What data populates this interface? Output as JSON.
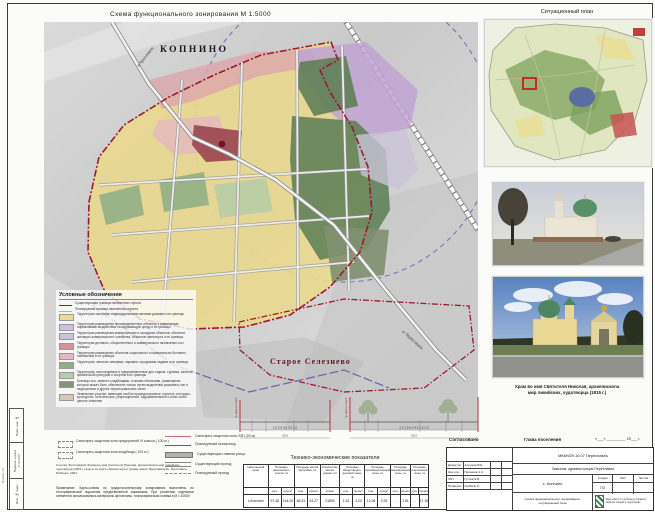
{
  "page": {
    "map_title": "Схема функционального зонирования М 1:5000",
    "compass": "С"
  },
  "map": {
    "town": "КОПНИНО",
    "village": "Старое Селезнево",
    "road_top": "в Ярославль",
    "road_bottom": "в Переславль"
  },
  "legend": {
    "title": "Условные обозначения",
    "lines": [
      {
        "label": "Существующая граница населенного пункта"
      },
      {
        "label": "Планируемая граница населенного пункта"
      }
    ],
    "zones": [
      {
        "color": "#ecd995",
        "label": "Территории застройки индивидуальными жилыми домами и их границы"
      },
      {
        "color": "#d2bfe0",
        "label": "Территории размещения производственных объектов с различными нормативами воздействия на окружающую среду и их границы"
      },
      {
        "color": "#c9c4d8",
        "label": "Территории размещения коммунальных и складских объектов, объектов жилищно-коммунального хозяйства, объектов транспорта и их границы"
      },
      {
        "color": "#d4929c",
        "label": "Территории делового, общественного и коммерческого назначения и их границы"
      },
      {
        "color": "#e6b8c0",
        "label": "Территории размещения объектов социального и коммунально-бытового назначения и их границы"
      },
      {
        "color": "#8fae85",
        "label": "Территории, занятые скверами, парками, городскими садами и их границы"
      },
      {
        "color": "#b5cda8",
        "label": "Территории, используемые и предназначенные для отдыха, туризма, занятий физической культурой и спортом и их границы"
      },
      {
        "color": "#879277",
        "label": "Границы зон, занятых кладбищами, и иными объектами, размещение которых может быть обеспечено только путем выделения указанных зон и недопустимо в других территориальных зонах"
      },
      {
        "color": "#d6c7b8",
        "label": "Земельные участки, имеющие особое природоохранное, научное, историко-культурное, эстетическое, рекреационное, оздоровительное и иное особо ценное значение"
      }
    ],
    "sanitary": [
      {
        "label": "Санитарно-защитная зона предприятий IV класса ( 100 м )"
      },
      {
        "label": "Санитарно-защитная зона кладбища ( 100 м )"
      }
    ],
    "right_items": [
      {
        "label": "Санитарно-защитная зона ЛЭП (20 м)"
      },
      {
        "label": "Планируемый газопровод"
      },
      {
        "label": "Существующая главная улица"
      },
      {
        "label": "Существующий проезд"
      },
      {
        "label": "Планируемый проезд"
      }
    ]
  },
  "profiles": {
    "redline": "Гр. красных линий",
    "p1_dims": "1,5      3,5      6,0      3,5      1,5",
    "p1_total": "15,0",
    "p2_dims": "2,0    1,5    6,0    4,5    1,5    2,0",
    "p2_total": "25,0"
  },
  "notes": {
    "reference": "Ссылка: Фотографии Храма во имя Святителя Николая, архиепископа мир ликийских, чудотворца (1815 г.) взяты из книги «Монастыри и храмы земли Ярославской», Ярославль-Рыбинск, 2001.",
    "note": "Примечание. Карты-схемы по градостроительному зонированию выполнены по топографической подоснове представленной заказчиком. При уточнении отдельных элементов использовались материалы фотопланы, топографическая съемка в М 1:10000"
  },
  "table": {
    "title": "Технико-экономические показатели",
    "cols": [
      {
        "title": "Населенный пункт",
        "vals": [
          "с.Копнино"
        ]
      },
      {
        "title": "Площадь населенного пункта, га",
        "subs": [
          "сущ.",
          "проект"
        ],
        "vals": [
          "97.48",
          "144.00"
        ]
      },
      {
        "title": "Площадь жилой застройки, га",
        "subs": [
          "сущ.",
          "проект"
        ],
        "vals": [
          "66.31",
          "43.27"
        ]
      },
      {
        "title": "Количество жилых домов, шт",
        "subs": [
          "проект"
        ],
        "vals": [
          "21800"
        ]
      },
      {
        "title": "Площадь общественно-деловой зоны, га",
        "subs": [
          "сущ.",
          "проект"
        ],
        "vals": [
          "1.51",
          "4.23"
        ]
      },
      {
        "title": "Площадь производственной зоны, га",
        "subs": [
          "сущ.",
          "проект"
        ],
        "vals": [
          "12.06",
          "2.25"
        ]
      },
      {
        "title": "Площадь рекреационной зоны, га",
        "subs": [
          "сущ.",
          "проект"
        ],
        "vals": [
          "-",
          "1.51"
        ]
      },
      {
        "title": "Площадь озеленения зоны, га",
        "subs": [
          "сущ.",
          "проект"
        ],
        "vals": [
          "-",
          "17.15"
        ]
      }
    ]
  },
  "right_panel": {
    "situational_title": "Ситуационный план",
    "photo_caption_1": "Храм во имя Святителя Николая, архиепископа",
    "photo_caption_2": "мир ликийских, чудотворца (1815 г.)"
  },
  "approval": {
    "agreed": "Согласовано",
    "head": "Глава поселения",
    "date_blank": "«___» _________ 20___ г."
  },
  "stamp": {
    "code": "МК6Н/29.10.07 Переславль",
    "customer": "Заказчик: администрация Переславля",
    "object": "с. Копнино",
    "stage_label": "Стадия",
    "sheet_label": "Лист",
    "sheets_label": "Листов",
    "stage": "ПЗ",
    "doc_title": "Схема функционального зонирования, ситуационный план",
    "org": "Фонд «Институт проблем устойчивого развития городов и территорий»",
    "signers": [
      {
        "role": "Директор",
        "name": "Алтынов В.Е"
      },
      {
        "role": "Нач.отд.",
        "name": "Пеганков А.А"
      },
      {
        "role": "ГАП",
        "name": "Гутчев Е.В"
      },
      {
        "role": "Проверил",
        "name": "Скиба Е.Э."
      }
    ]
  },
  "frame": {
    "box1": "Взам. инв. №",
    "box2": "Подпись и дата",
    "date": "17.03.2010",
    "box3": "Инв. № подл.",
    "format": "Формат А1"
  },
  "colors": {
    "boundary": "#9b1b2e",
    "circle_zone": "#7a74b8",
    "pipeline": "#6a5fb0",
    "marker_red": "#d01818"
  }
}
